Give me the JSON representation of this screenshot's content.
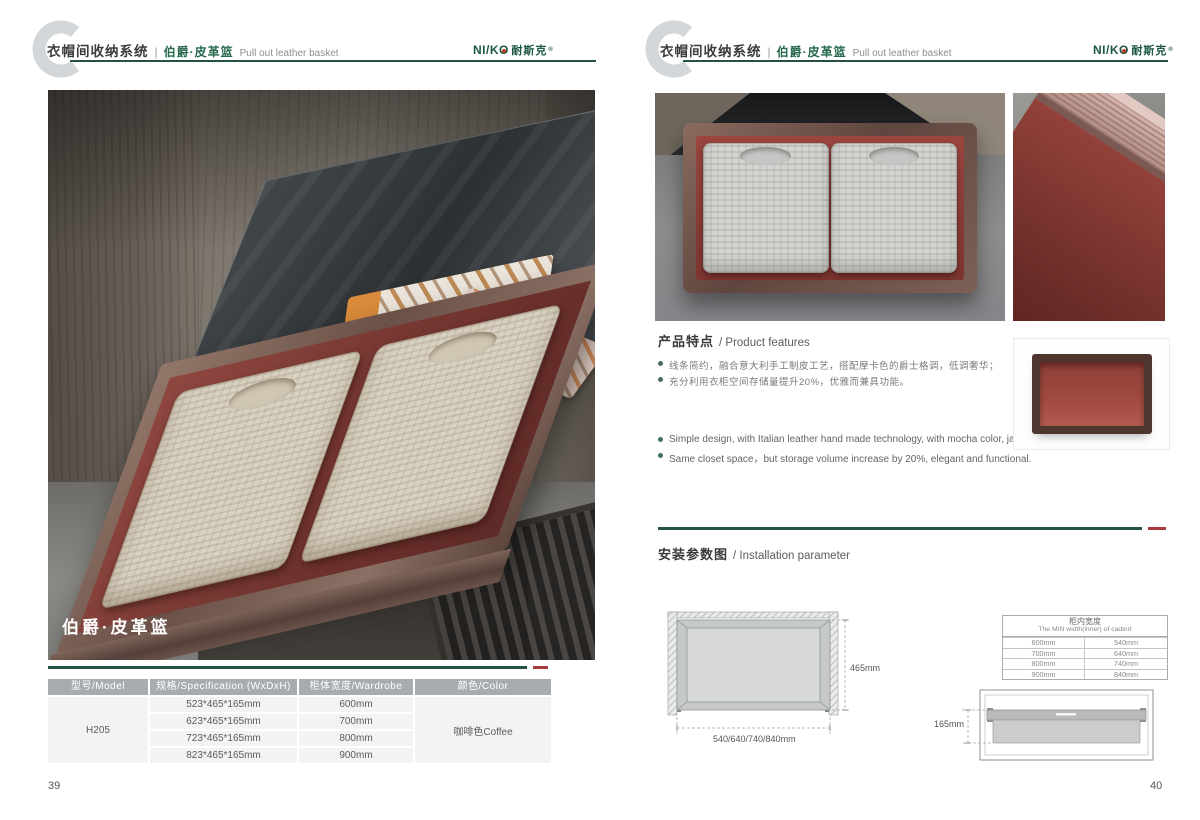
{
  "logo": {
    "part1": "NI/K",
    "part2": "O",
    "cn": "耐斯克",
    "reg": "®"
  },
  "header": {
    "system_title": "衣帽间收纳系统",
    "divider": "|",
    "product_cn": "伯爵·皮革篮",
    "product_en": "Pull out leather basket"
  },
  "left_page": {
    "photo_caption": "伯爵·皮革篮",
    "page_number": "39",
    "spec_table": {
      "headers": [
        "型号/Model",
        "规格/Specification (WxDxH)",
        "柜体宽度/Wardrobe width",
        "颜色/Color"
      ],
      "model": "H205",
      "rows": [
        {
          "spec": "523*465*165mm",
          "width": "600mm"
        },
        {
          "spec": "623*465*165mm",
          "width": "700mm"
        },
        {
          "spec": "723*465*165mm",
          "width": "800mm"
        },
        {
          "spec": "823*465*165mm",
          "width": "900mm"
        }
      ],
      "color": "咖啡色Coffee"
    }
  },
  "right_page": {
    "page_number": "40",
    "features": {
      "title_cn": "产品特点",
      "title_en": "/ Product features",
      "bullets_cn": [
        "线条简约，融合意大利手工制皮工艺，搭配摩卡色的爵士格调，低调奢华；",
        "充分利用衣柜空间存储量提升20%，优雅而兼具功能。"
      ],
      "bullets_en": [
        "Simple design, with Italian leather hand made technology, with mocha color, jazz luxury;",
        "Same closet space，but storage volume increase by 20%, elegant and functional."
      ]
    },
    "installation": {
      "title_cn": "安装参数图",
      "title_en": "/ Installation parameter",
      "top_view": {
        "height_label": "465mm",
        "width_label": "540/640/740/840mm"
      },
      "inner_width_table": {
        "title_cn": "柜内宽度",
        "title_en": "The MIN width(inner) of cadinrt",
        "rows": [
          [
            "600mm",
            "540mm"
          ],
          [
            "700mm",
            "640mm"
          ],
          [
            "800mm",
            "740mm"
          ],
          [
            "900mm",
            "840mm"
          ]
        ]
      },
      "side_view": {
        "height_label": "165mm"
      }
    }
  },
  "colors": {
    "brand_green": "#24523f",
    "accent_red": "#a93a3c",
    "table_header_bg": "#a8acaf",
    "table_cell_bg": "#f1f3f4",
    "leather_red": "#8e4038",
    "frame_bronze": "#6f5348"
  }
}
